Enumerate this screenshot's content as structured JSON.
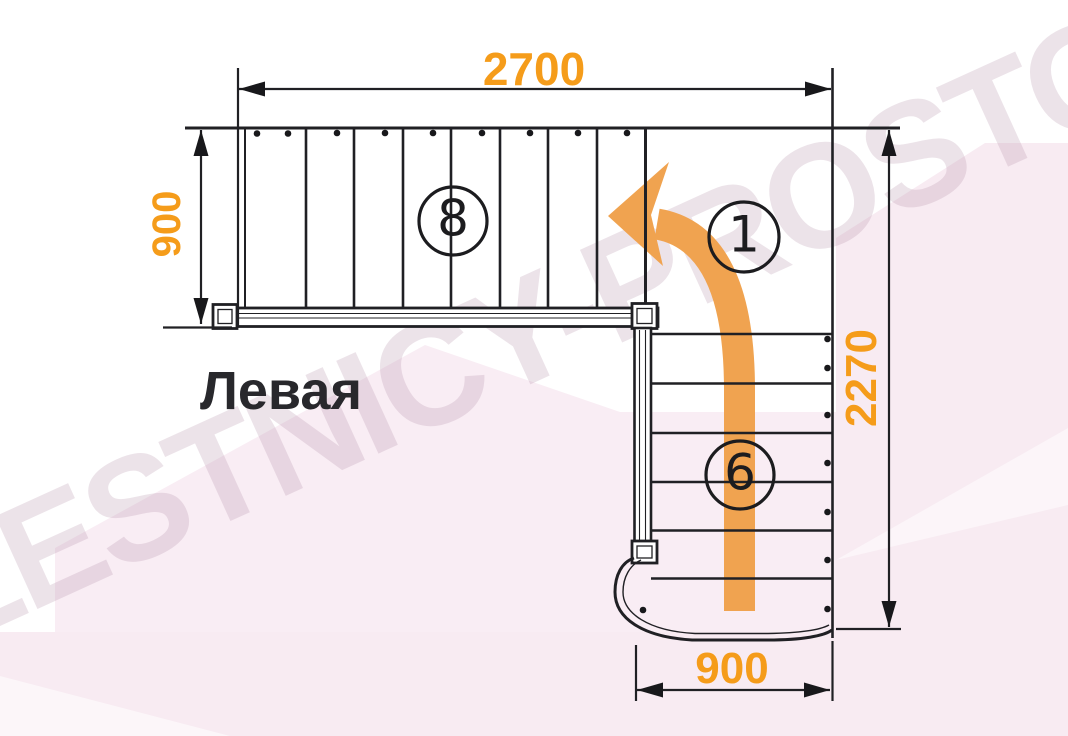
{
  "diagram": {
    "label": "Левая",
    "watermark": "LESTNICY-PROSTO.RU",
    "dims": {
      "top_width": "2700",
      "upper_flight_depth": "900",
      "right_height": "2270",
      "bottom_width": "900"
    },
    "counts": {
      "upper_flight_steps": "8",
      "turn_landing": "1",
      "lower_flight_steps": "6"
    },
    "colors": {
      "dimension_text": "#F59C1A",
      "walk_arrow": "#F0A350",
      "line_black": "#202024",
      "background_tint": "#F9EDF4"
    }
  }
}
